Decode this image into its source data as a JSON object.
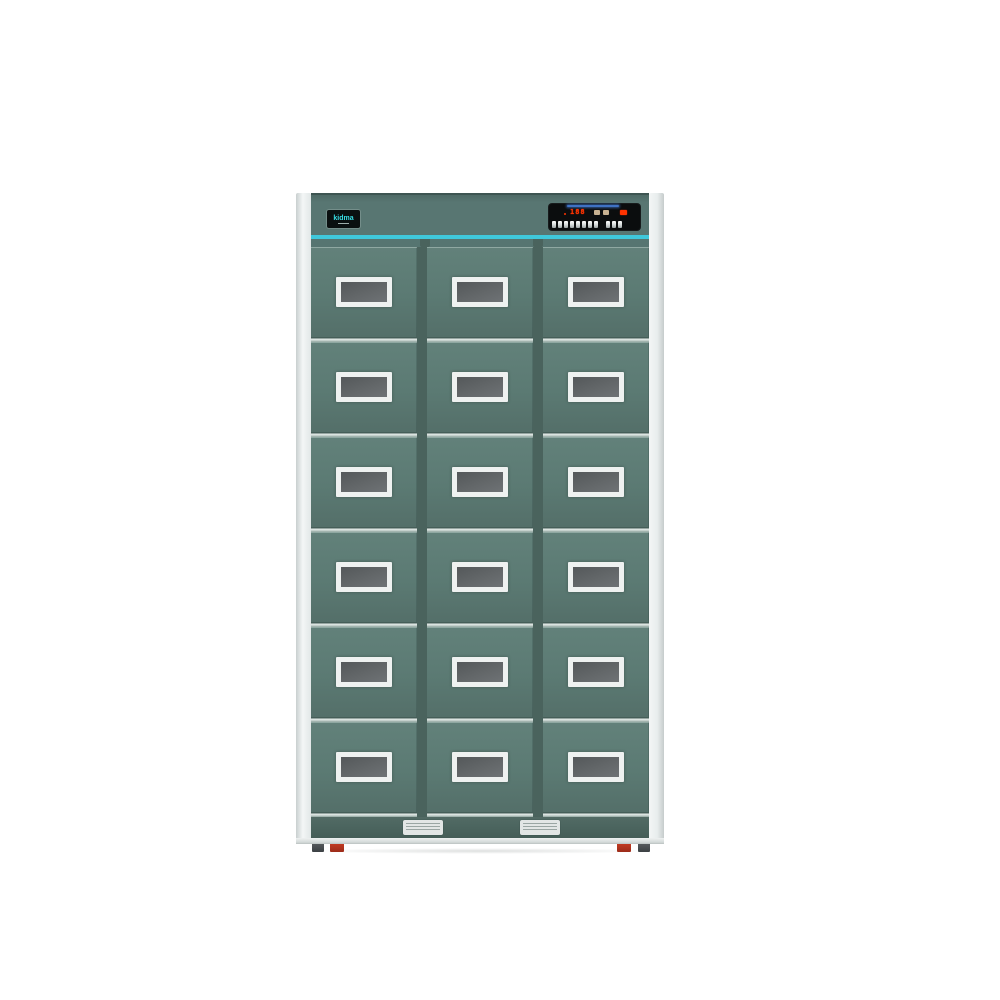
{
  "scene": {
    "type": "product-photo",
    "description": "Freestanding 18-compartment green locker / disinfection cabinet, front view, on white background",
    "background_color": "#ffffff"
  },
  "cabinet": {
    "brand": {
      "label": "kidma",
      "text_color": "#38dfe6",
      "badge_bg": "#0a1010"
    },
    "control_panel": {
      "display": {
        "reading": "188",
        "led_color": "#ff3300",
        "glow_color": "#3f72c4",
        "icon_names": [
          "status-icon-a",
          "status-icon-b",
          "power-indicator"
        ]
      },
      "buttons": {
        "group1_count": 8,
        "group2_count": 3
      }
    },
    "grid": {
      "rows": 6,
      "columns": 3,
      "total_compartments": 18
    },
    "window": {
      "style": "white-framed frosted rectangle, one per door"
    },
    "vents": {
      "count": 2
    },
    "feet": {
      "red_count": 2,
      "dark_count": 2
    },
    "colors": {
      "door_green": "#5b7a73",
      "header_green": "#587672",
      "divider_green": "#4a635d",
      "base_green": "#4a635d",
      "accent_teal": "#3fc8db",
      "side_frame": "#eef1f1",
      "window_frame": "#eef1f0",
      "window_glass": "#636769",
      "vent_silver": "#e2e6e5",
      "foot_red": "#b23420",
      "foot_dark": "#45494c"
    }
  }
}
